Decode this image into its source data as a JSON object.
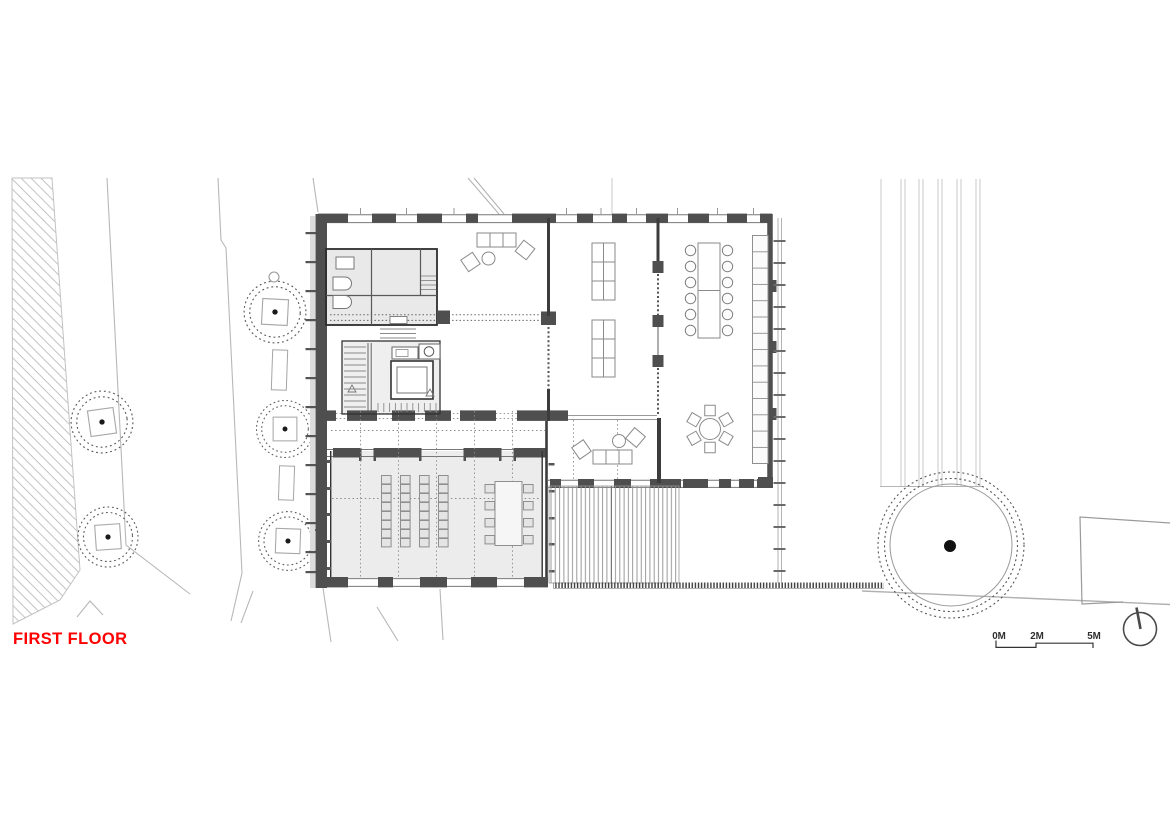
{
  "plan": {
    "title": "FIRST FLOOR",
    "title_color": "#ff0000"
  },
  "scale_bar": {
    "labels": [
      "0M",
      "2M",
      "5M"
    ]
  },
  "site": {
    "small_tree_count": 5,
    "large_tree_count": 1,
    "bench_count": 2
  },
  "icons": {
    "north_arrow": "north-arrow-icon",
    "tree": "tree-icon",
    "scale_bar": "scale-bar"
  },
  "colors": {
    "wall_dark": "#4f4f4f",
    "wall_outline": "#333333",
    "room_floor_tint": "#ececec",
    "furniture_line": "#8a8a8a",
    "site_line": "#b5b5b5",
    "deck_line": "#8a8a8a",
    "label_red": "#ff0000",
    "scale_text": "#2f2f2f",
    "paper": "#ffffff"
  }
}
